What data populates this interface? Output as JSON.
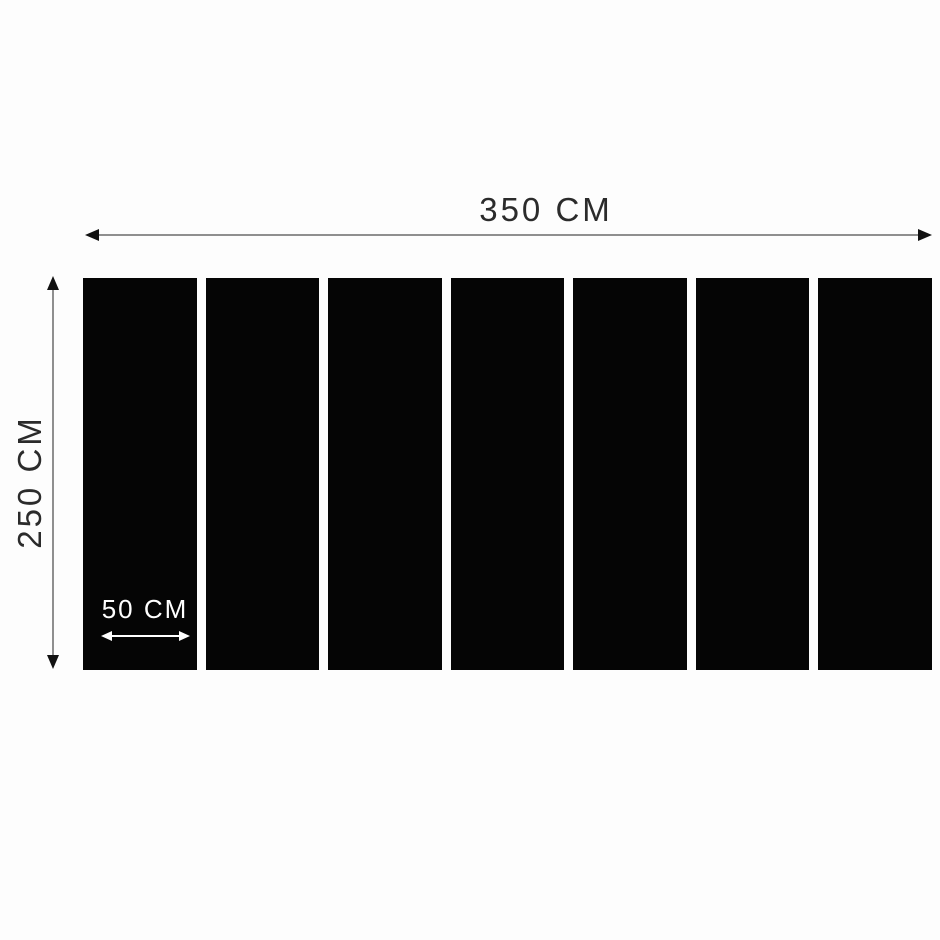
{
  "image": {
    "type": "product-dimension-diagram",
    "background_color": "#fdfdfd"
  },
  "dimensions": {
    "total_width_label": "350 CM",
    "total_height_label": "250 CM",
    "panel_width_label": "50 CM"
  },
  "panels": {
    "count": 7,
    "color": "#050505"
  },
  "style": {
    "line_color": "#8f8f8f",
    "arrowhead_color": "#111111",
    "text_color": "#2b2b2b",
    "panel_label_color": "#ffffff"
  }
}
